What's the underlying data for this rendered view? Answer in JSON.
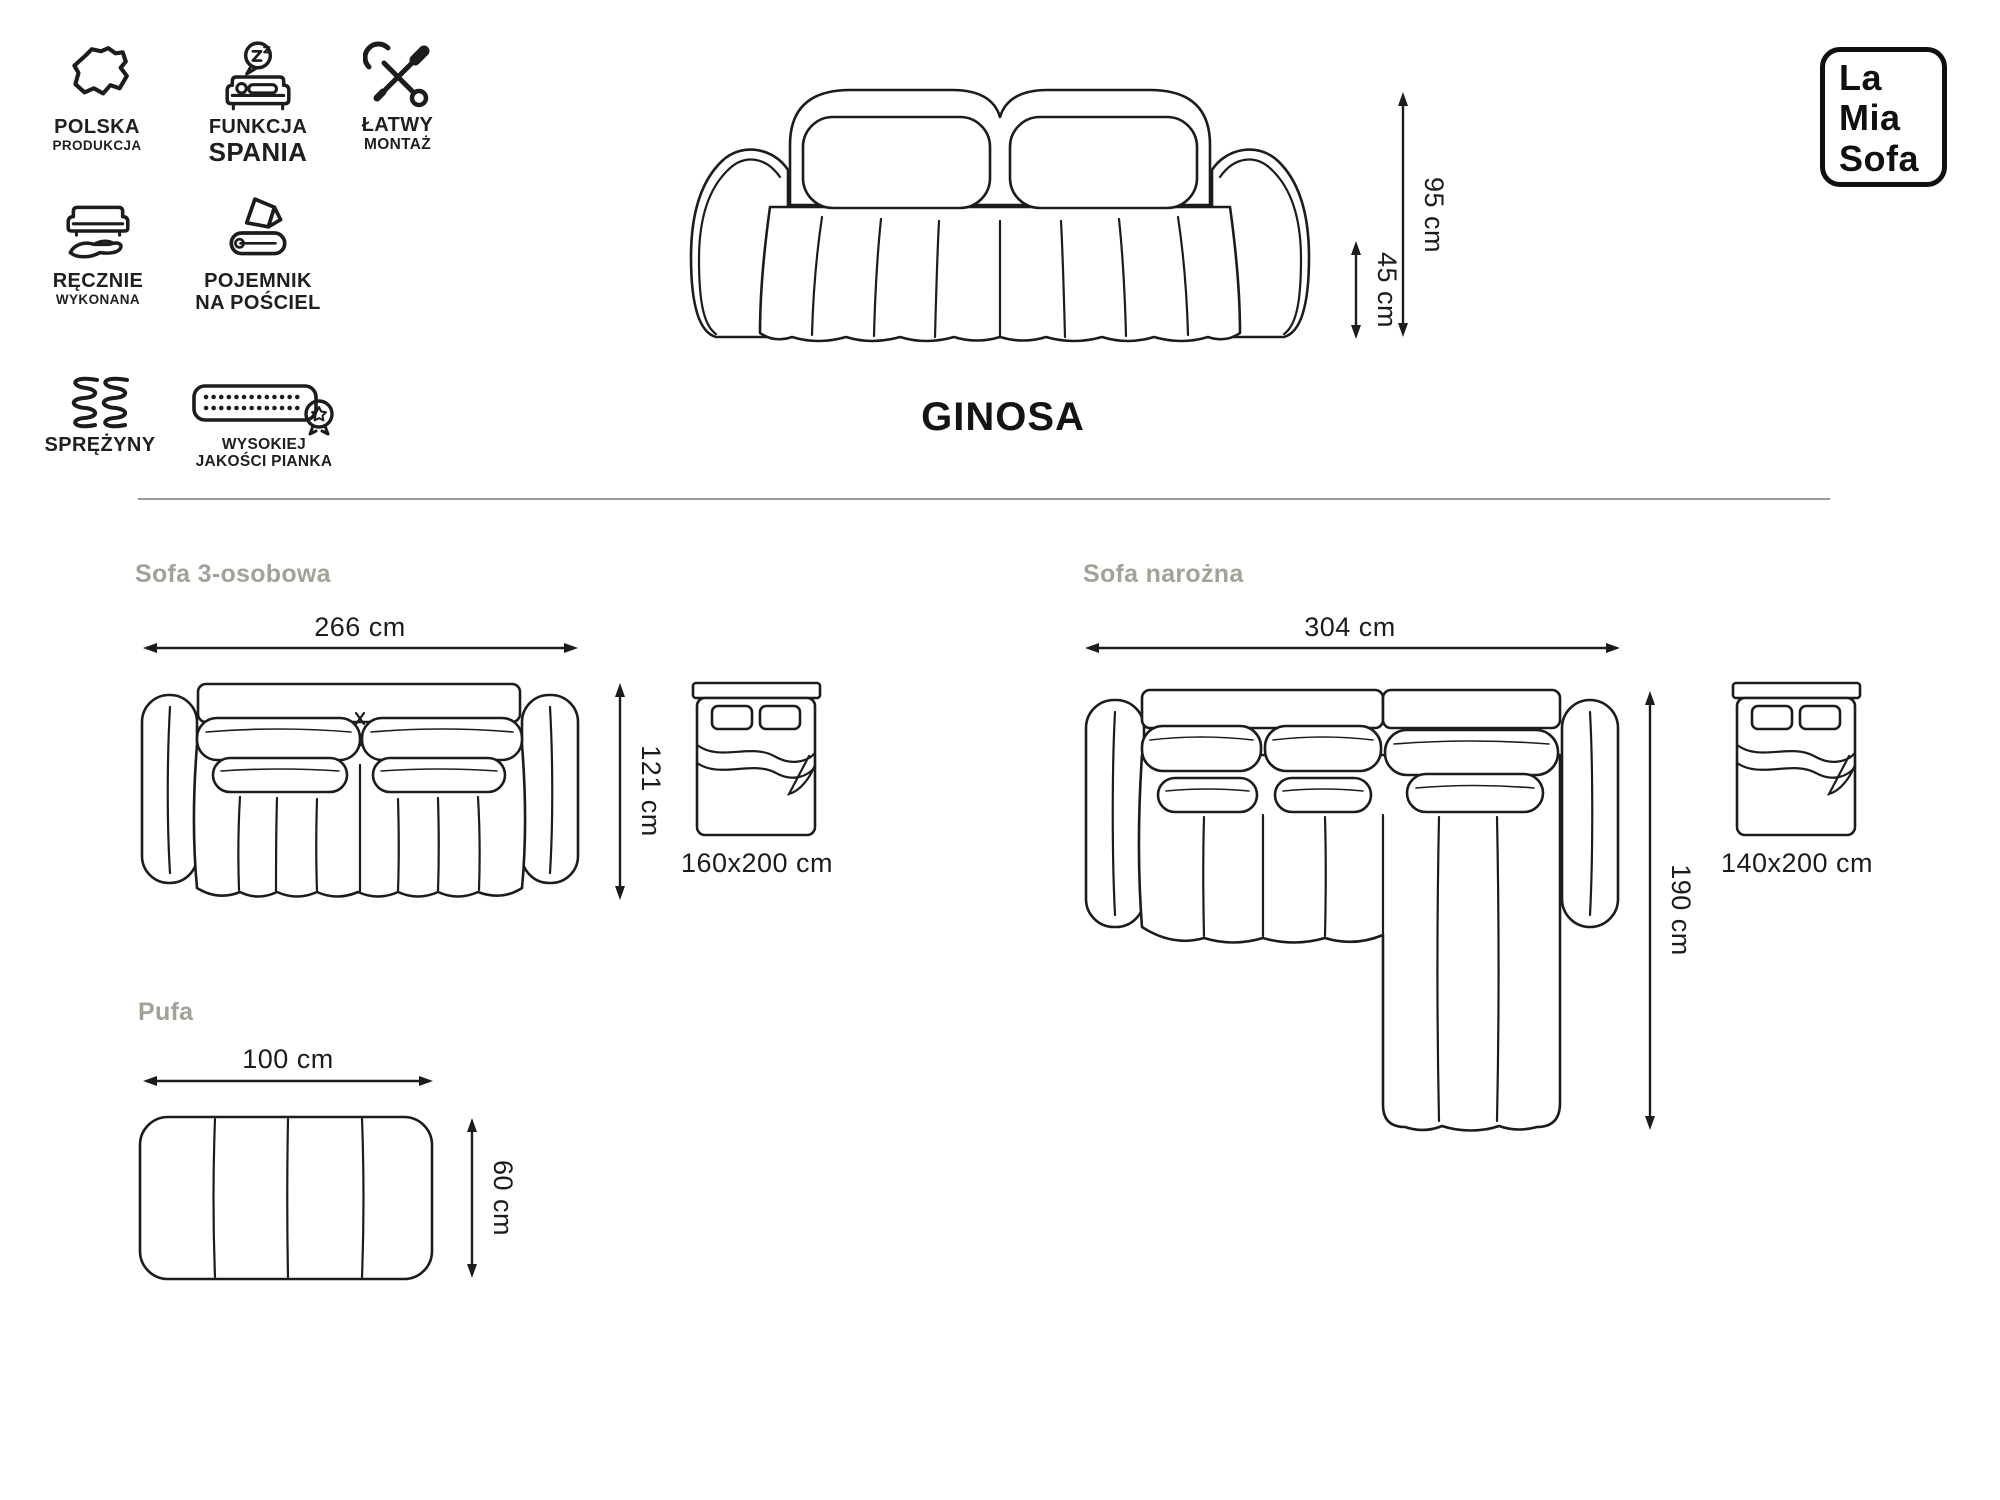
{
  "logo": {
    "line1": "La",
    "line2": "Mia",
    "line3": "Sofa"
  },
  "product": {
    "name": "GINOSA"
  },
  "badges": [
    {
      "icon": "poland-map-icon",
      "line1": "POLSKA",
      "line2": "PRODUKCJA"
    },
    {
      "icon": "sleep-function-icon",
      "line1": "FUNKCJA",
      "line2": "SPANIA"
    },
    {
      "icon": "easy-assembly-icon",
      "line1": "ŁATWY",
      "line2": "MONTAŻ"
    },
    {
      "icon": "handmade-icon",
      "line1": "RĘCZNIE",
      "line2": "WYKONANA"
    },
    {
      "icon": "bedding-storage-icon",
      "line1": "POJEMNIK",
      "line2": "NA POŚCIEL"
    },
    {
      "icon": "springs-icon",
      "line1": "SPRĘŻYNY",
      "line2": ""
    },
    {
      "icon": "foam-quality-icon",
      "line1": "WYSOKIEJ",
      "line2": "JAKOŚCI PIANKA"
    }
  ],
  "hero": {
    "height": "95 cm",
    "seat_height": "45 cm"
  },
  "sections": {
    "sofa3": {
      "title": "Sofa 3-osobowa",
      "width": "266 cm",
      "depth": "121 cm",
      "bed_size": "160x200 cm"
    },
    "corner": {
      "title": "Sofa narożna",
      "width": "304 cm",
      "depth": "190 cm",
      "bed_size": "140x200 cm"
    },
    "pouf": {
      "title": "Pufa",
      "width": "100 cm",
      "depth": "60 cm"
    }
  },
  "colors": {
    "ink": "#1c1c1c",
    "muted_title": "#a3a296",
    "divider": "#9b9b9b",
    "background": "#ffffff"
  }
}
